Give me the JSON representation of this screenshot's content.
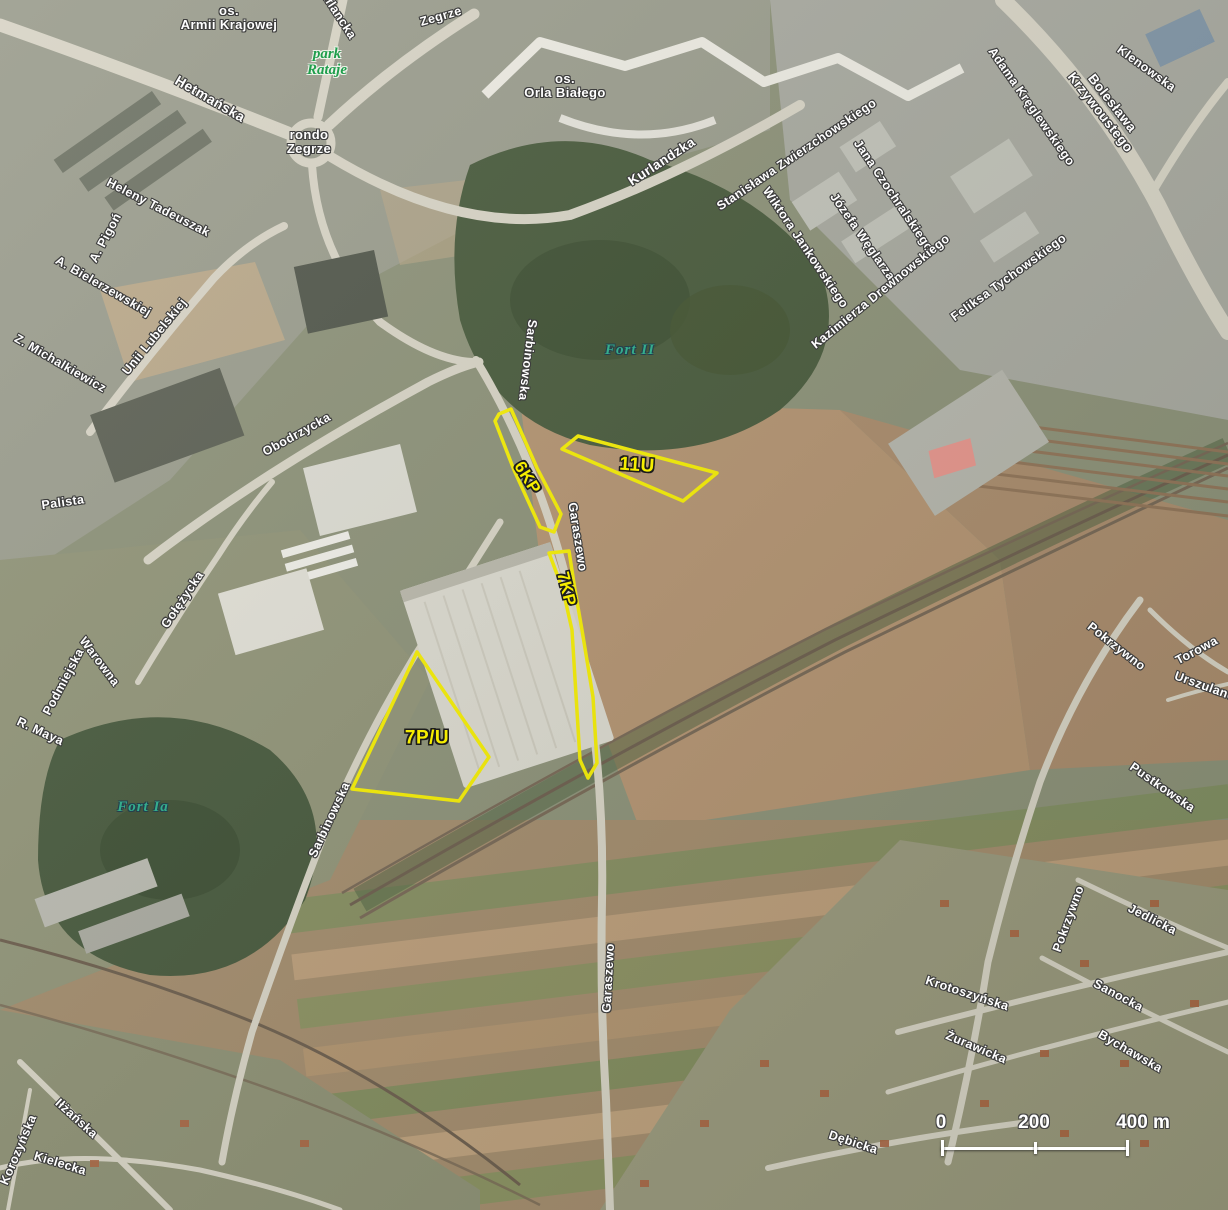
{
  "map_title": "aerial planning map — Poznań Franowo / Garaszewo area",
  "colors": {
    "zone_outline": "#f6ee00",
    "zone_label": "#f6ee00",
    "street_label": "#ffffff",
    "street_halo": "#3d3d3d",
    "fort_label": "#35ad8d",
    "park_label": "#1f9e4c",
    "scale_bar": "#ffffff"
  },
  "zones": [
    {
      "name": "6KP",
      "label": "6KP",
      "label_x": 527,
      "label_y": 478,
      "label_rotate": 58,
      "label_size": 17,
      "points": "499,414 511,409 537,468 561,514 554,532 540,527 514,470 495,421"
    },
    {
      "name": "11U",
      "label": "11U",
      "label_x": 637,
      "label_y": 466,
      "label_rotate": 4,
      "label_size": 19,
      "points": "562,449 578,436 717,473 683,501"
    },
    {
      "name": "7KP",
      "label": "7KP",
      "label_x": 566,
      "label_y": 589,
      "label_rotate": 76,
      "label_size": 17,
      "points": "549,553 569,551 575,590 582,630 593,697 597,763 588,778 580,760 572,630 563,590"
    },
    {
      "name": "7P/U",
      "label": "7P/U",
      "label_x": 427,
      "label_y": 739,
      "label_rotate": 0,
      "label_size": 19,
      "points": "417,652 489,757 459,801 352,789"
    }
  ],
  "street_labels": [
    {
      "text": "os.\nArmii Krajowej",
      "x": 229,
      "y": 18,
      "r": 0,
      "s": 13
    },
    {
      "text": "Inflancka",
      "x": 337,
      "y": 14,
      "r": 57
    },
    {
      "text": "Zegrze",
      "x": 441,
      "y": 17,
      "r": -16
    },
    {
      "text": "Hetmańska",
      "x": 210,
      "y": 99,
      "r": 30,
      "s": 14
    },
    {
      "text": "rondo\nZegrze",
      "x": 309,
      "y": 142,
      "r": 0,
      "s": 13
    },
    {
      "text": "os.\nOrla Białego",
      "x": 565,
      "y": 86,
      "r": 0,
      "s": 13
    },
    {
      "text": "Kurlandzka",
      "x": 662,
      "y": 162,
      "r": -33,
      "s": 13.5
    },
    {
      "text": "Stanisława Zwierzchowskiego",
      "x": 797,
      "y": 155,
      "r": -34
    },
    {
      "text": "Jana Czochralskiego",
      "x": 893,
      "y": 196,
      "r": 56
    },
    {
      "text": "Wiktora Jankowskiego",
      "x": 805,
      "y": 248,
      "r": 56
    },
    {
      "text": "Józefa Węglarza",
      "x": 862,
      "y": 237,
      "r": 55
    },
    {
      "text": "Kazimierza Drewnowskiego",
      "x": 881,
      "y": 292,
      "r": -39
    },
    {
      "text": "Adama Kręglewskiego",
      "x": 1031,
      "y": 107,
      "r": 55
    },
    {
      "text": "Bolesława Krzywoustego",
      "x": 1106,
      "y": 108,
      "r": 52,
      "s": 13.5
    },
    {
      "text": "Klenowska",
      "x": 1146,
      "y": 69,
      "r": 36
    },
    {
      "text": "Feliksa Tychowskiego",
      "x": 1009,
      "y": 278,
      "r": -36
    },
    {
      "text": "Heleny Tadeuszak",
      "x": 158,
      "y": 208,
      "r": 27
    },
    {
      "text": "A. Pigoń",
      "x": 106,
      "y": 238,
      "r": -62
    },
    {
      "text": "A. Bielerzewskiej",
      "x": 103,
      "y": 287,
      "r": 30
    },
    {
      "text": "Z. Michalkiewicz",
      "x": 60,
      "y": 364,
      "r": 30
    },
    {
      "text": "Unii Lubelskiej",
      "x": 155,
      "y": 337,
      "r": -51
    },
    {
      "text": "Palista",
      "x": 63,
      "y": 503,
      "r": -8
    },
    {
      "text": "Obodrzycka",
      "x": 297,
      "y": 435,
      "r": -29
    },
    {
      "text": "Sarbinowska",
      "x": 527,
      "y": 360,
      "r": 97
    },
    {
      "text": "Garaszewo",
      "x": 577,
      "y": 537,
      "r": 81
    },
    {
      "text": "Gołężycka",
      "x": 183,
      "y": 600,
      "r": -56
    },
    {
      "text": "Warowna",
      "x": 99,
      "y": 662,
      "r": 53
    },
    {
      "text": "Podmiejska",
      "x": 64,
      "y": 682,
      "r": -62
    },
    {
      "text": "R. Maya",
      "x": 40,
      "y": 732,
      "r": 25
    },
    {
      "text": "Sarbinowska",
      "x": 330,
      "y": 820,
      "r": -65
    },
    {
      "text": "Garaszewo",
      "x": 609,
      "y": 978,
      "r": -87
    },
    {
      "text": "Pokrzywno",
      "x": 1116,
      "y": 647,
      "r": 38
    },
    {
      "text": "Torowa",
      "x": 1197,
      "y": 651,
      "r": -28
    },
    {
      "text": "Urszulanek",
      "x": 1208,
      "y": 688,
      "r": 20
    },
    {
      "text": "Pustkowska",
      "x": 1162,
      "y": 788,
      "r": 35
    },
    {
      "text": "Pokrzywno",
      "x": 1069,
      "y": 919,
      "r": -70
    },
    {
      "text": "Jedlicka",
      "x": 1152,
      "y": 920,
      "r": 27
    },
    {
      "text": "Krotoszyńska",
      "x": 967,
      "y": 994,
      "r": 18
    },
    {
      "text": "Sanocka",
      "x": 1118,
      "y": 996,
      "r": 28
    },
    {
      "text": "Żurawicka",
      "x": 976,
      "y": 1048,
      "r": 23
    },
    {
      "text": "Bychawska",
      "x": 1130,
      "y": 1052,
      "r": 30
    },
    {
      "text": "Dębicka",
      "x": 853,
      "y": 1143,
      "r": 18
    },
    {
      "text": "Iłżańska",
      "x": 76,
      "y": 1119,
      "r": 42
    },
    {
      "text": "Kielecka",
      "x": 60,
      "y": 1164,
      "r": 17
    },
    {
      "text": "Korozyńska",
      "x": 19,
      "y": 1150,
      "r": -67
    }
  ],
  "fort_labels": [
    {
      "text": "Fort II",
      "x": 630,
      "y": 350,
      "r": 0
    },
    {
      "text": "Fort Ia",
      "x": 143,
      "y": 807,
      "r": 0
    }
  ],
  "park_labels": [
    {
      "text": "park\nRataje",
      "x": 327,
      "y": 62,
      "r": 0
    }
  ],
  "scale_bar": {
    "labels": [
      "0",
      "200",
      "400 m"
    ],
    "values_m": [
      0,
      200,
      400
    ]
  }
}
